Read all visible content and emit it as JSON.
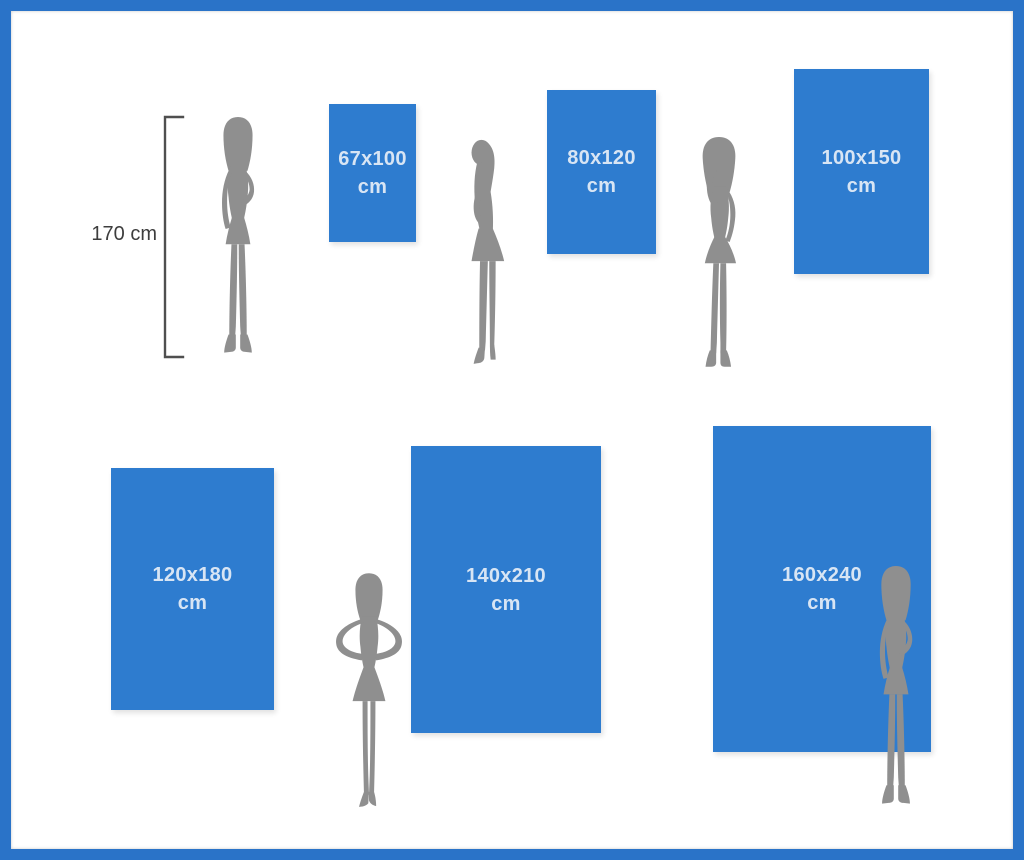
{
  "reference": {
    "height_label": "170 cm"
  },
  "posters": [
    {
      "size": "67x100",
      "unit": "cm"
    },
    {
      "size": "80x120",
      "unit": "cm"
    },
    {
      "size": "100x150",
      "unit": "cm"
    },
    {
      "size": "120x180",
      "unit": "cm"
    },
    {
      "size": "140x210",
      "unit": "cm"
    },
    {
      "size": "160x240",
      "unit": "cm"
    }
  ],
  "figures": [
    "woman-standing-front",
    "woman-side-profile",
    "woman-hand-to-face",
    "woman-hands-on-hips",
    "woman-standing-front"
  ],
  "colors": {
    "frame_blue": "#2a73c8",
    "poster_blue": "#2e7ccf",
    "poster_label": "#d8e5f4",
    "silhouette_gray": "#8f8f8f",
    "bracket_gray": "#4f4f4f",
    "measure_text": "#3d3d3d",
    "background": "#ffffff"
  }
}
